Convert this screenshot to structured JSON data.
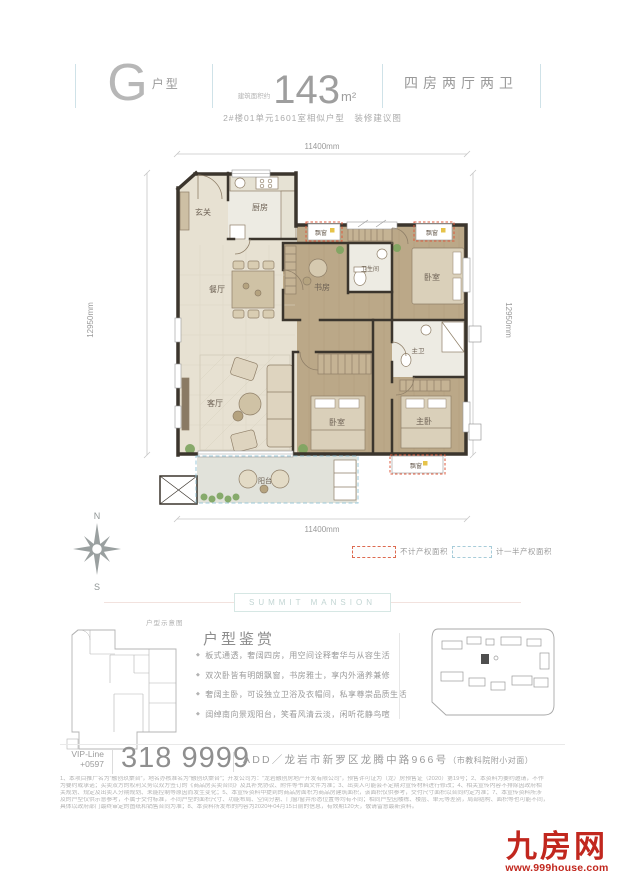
{
  "header": {
    "type_letter": "G",
    "type_label": "户型",
    "area_label": "建筑面积约",
    "area_value": "143",
    "area_unit": "m²",
    "rooms_label": "四房两厅两卫",
    "subtitle": "2#楼01单元1601室相似户型　装修建议图"
  },
  "floorplan": {
    "dim_h": "11400mm",
    "dim_v": "12950mm",
    "rooms": {
      "entry": "玄关",
      "kitchen": "厨房",
      "dining": "餐厅",
      "living": "客厅",
      "study": "书房",
      "bath": "卫生间",
      "bedroom_a": "卧室",
      "bedroom_b": "卧室",
      "master_bath": "主卫",
      "master": "主卧",
      "balcony": "阳台",
      "bay": "飘窗"
    }
  },
  "compass": {
    "north": "N",
    "south": "S"
  },
  "legend": {
    "no_property": "不计产权面积",
    "half_property": "计一半产权面积"
  },
  "badge": {
    "text": "SUMMIT MANSION"
  },
  "appreciation": {
    "thumb_label": "户型示意图",
    "title": "户型鉴赏",
    "bullets": [
      "板式通透，奢阔四房，用空间诠释奢华与从容生活",
      "双次卧皆有明朗飘窗，书房雅士，享内外涵养兼修",
      "奢阔主卧，可设独立卫浴及衣帽间，私享尊崇品质生活",
      "阔绰南向景观阳台，笑看风清云淡，闲听花静鸟喧"
    ]
  },
  "contact": {
    "vip_label": "VIP-Line",
    "vip_code": "+0597",
    "phone": "318 9999",
    "address_main": "ADD／龙岩市新罗区龙腾中路966号",
    "address_note": "（市教科院附小对面）"
  },
  "disclaimer": [
    "1、本项目推广名为“融创玖棠台”，地名办核准名为“融创玖棠台”；开发公司为：“龙岩融创房地产开发有限公司”，预售许可证为（龙）房预售证（2020）第19号；2、本资料为要约邀请，不作",
    "为要约或承诺；买卖双方的权利义务以双方签订的《商品房买卖合同》及其补充协议、附件等书面文件为准；3、出卖人可能会不定期对宣传材料进行修改；4、相关宣传内容不排除因政府相",
    "关规划、规定及出卖人分期规划、未能控制等原因而发生变化；5、本宣传资料中提到的商品房面积为商品房建筑面积，该面积仅供参考，交付尺寸面积以合同约定为准；7、本宣传资料所涉",
    "及的户型仅供示意参考，不属于交付标准，不同户型的面积尺寸、功能布局、空间分割、门窗/窗井形态位置等均有不同；相同户型因楼栋、楼层、单元等差别，局部结构、面积等也可能不同，",
    "具体以政府部门最终审定的图纸和销售合同为准；8、本资料所发布的内容为2020年04月15日前的信息，有效期120天，敬请留意最新资料。"
  ],
  "logo": {
    "name": "九房网",
    "site": "www.999house.com"
  },
  "colors": {
    "accent_red": "#c1271e",
    "dash_red": "#dd5a3c",
    "dash_blue": "#9cc8d8",
    "separator_blue": "#cfe2e8"
  }
}
